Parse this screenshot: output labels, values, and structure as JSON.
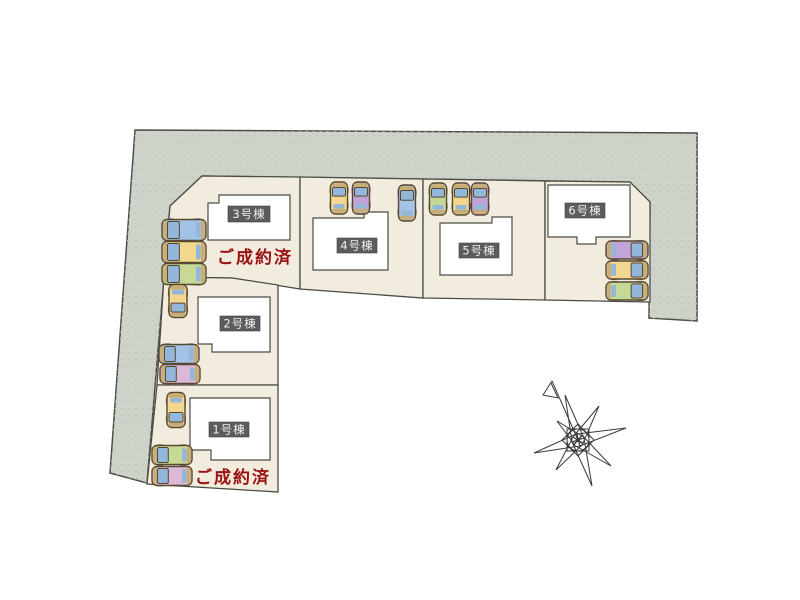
{
  "plan": {
    "type": "housing-site-plan",
    "buildings": [
      {
        "label": "1号棟",
        "sold_note": "ご成約済"
      },
      {
        "label": "2号棟",
        "sold_note": ""
      },
      {
        "label": "3号棟",
        "sold_note": "ご成約済"
      },
      {
        "label": "4号棟",
        "sold_note": ""
      },
      {
        "label": "5号棟",
        "sold_note": ""
      },
      {
        "label": "6号棟",
        "sold_note": ""
      }
    ],
    "sold_labels": [
      {
        "text": "ご成約済",
        "attached_to": "3号棟"
      },
      {
        "text": "ご成約済",
        "attached_to": "1号棟"
      }
    ]
  },
  "colors": {
    "surrounding_area": "#ced4ca",
    "surrounding_texture": "#c2c9be",
    "lot_fill": "#f2ecde",
    "building_fill": "#ffffff",
    "boundary_line": "#4c4c46",
    "label_box": "#5c5c5c",
    "label_text": "#f0f0f0",
    "sold_text": "#991111",
    "car_windshield": "#93b6db",
    "car_trim": "#c7ae78",
    "car_outline": "#584830",
    "car_wheel": "#666666"
  },
  "car_colors": {
    "blue": "#a3c3e6",
    "yellow": "#f3d78e",
    "green": "#c6da96",
    "purple": "#c2a5d8",
    "pink": "#dcb8d8"
  },
  "cars": [
    {
      "x": 184,
      "y": 230,
      "len": 44,
      "wid": 21,
      "dir": "left",
      "color": "blue"
    },
    {
      "x": 184,
      "y": 252,
      "len": 44,
      "wid": 21,
      "dir": "left",
      "color": "yellow"
    },
    {
      "x": 184,
      "y": 274,
      "len": 44,
      "wid": 21,
      "dir": "left",
      "color": "green"
    },
    {
      "x": 339,
      "y": 198,
      "len": 32,
      "wid": 17,
      "dir": "up",
      "color": "yellow"
    },
    {
      "x": 361,
      "y": 198,
      "len": 32,
      "wid": 17,
      "dir": "up",
      "color": "purple"
    },
    {
      "x": 407,
      "y": 203,
      "len": 36,
      "wid": 17,
      "dir": "up",
      "color": "blue"
    },
    {
      "x": 438,
      "y": 199,
      "len": 32,
      "wid": 17,
      "dir": "up",
      "color": "green"
    },
    {
      "x": 461,
      "y": 199,
      "len": 32,
      "wid": 17,
      "dir": "up",
      "color": "yellow"
    },
    {
      "x": 480,
      "y": 199,
      "len": 32,
      "wid": 17,
      "dir": "up",
      "color": "purple"
    },
    {
      "x": 627,
      "y": 250,
      "len": 42,
      "wid": 18,
      "dir": "right",
      "color": "purple"
    },
    {
      "x": 627,
      "y": 270,
      "len": 42,
      "wid": 18,
      "dir": "right",
      "color": "yellow"
    },
    {
      "x": 627,
      "y": 291,
      "len": 42,
      "wid": 18,
      "dir": "right",
      "color": "green"
    },
    {
      "x": 178,
      "y": 301,
      "len": 33,
      "wid": 18,
      "dir": "down",
      "color": "yellow"
    },
    {
      "x": 179,
      "y": 354,
      "len": 40,
      "wid": 19,
      "dir": "left",
      "color": "blue"
    },
    {
      "x": 180,
      "y": 374,
      "len": 40,
      "wid": 19,
      "dir": "left",
      "color": "pink"
    },
    {
      "x": 176,
      "y": 410,
      "len": 35,
      "wid": 18,
      "dir": "down",
      "color": "yellow"
    },
    {
      "x": 172,
      "y": 455,
      "len": 40,
      "wid": 19,
      "dir": "left",
      "color": "green"
    },
    {
      "x": 172,
      "y": 476,
      "len": 40,
      "wid": 19,
      "dir": "left",
      "color": "pink"
    }
  ],
  "compass": {
    "present": true,
    "style": "hand-drawn 8-point star with north arrow"
  }
}
